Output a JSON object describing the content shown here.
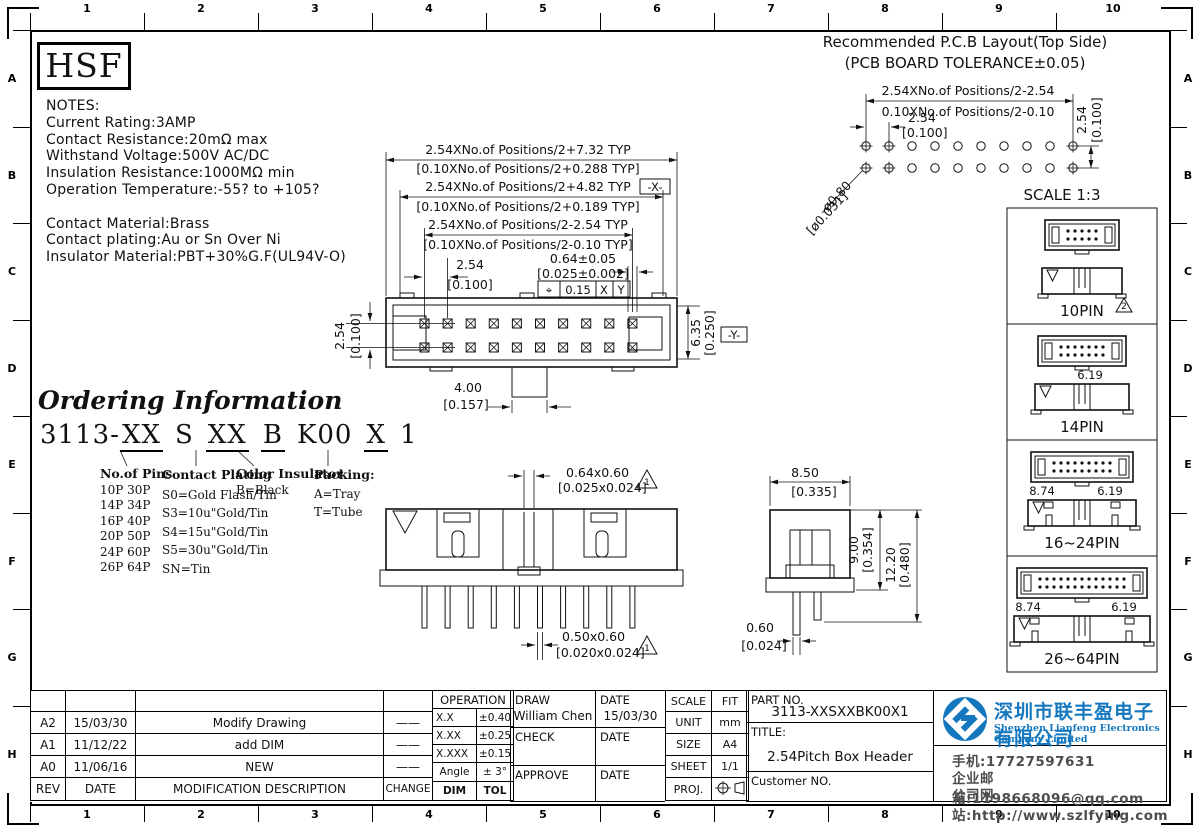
{
  "border": {
    "cols": [
      "1",
      "2",
      "3",
      "4",
      "5",
      "6",
      "7",
      "8",
      "9",
      "10"
    ],
    "rows": [
      "A",
      "B",
      "C",
      "D",
      "E",
      "F",
      "G",
      "H"
    ]
  },
  "logo": {
    "text": "HSF"
  },
  "notes": {
    "lines": [
      "NOTES:",
      "Current  Rating:3AMP",
      "Contact  Resistance:20mΩ    max",
      "Withstand  Voltage:500V  AC/DC",
      "Insulation  Resistance:1000MΩ  min",
      "Operation  Temperature:-55?  to  +105?",
      "",
      "Contact  Material:Brass",
      "Contact  plating:Au  or  Sn  Over  Ni",
      "Insulator  Material:PBT+30%G.F(UL94V-O)"
    ]
  },
  "pcb": {
    "title1": "Recommended  P.C.B  Layout(Top  Side)",
    "title2": "(PCB  BOARD  TOLERANCE±0.05)",
    "dim_row1": "2.54XNo.of Positions/2-2.54",
    "dim_row2": "0.10XNo.of Positions/2-0.10",
    "pitch": "2.54",
    "pitch_in": "[0.100]",
    "row_pitch": "2.54",
    "row_pitch_in": "[0.100]",
    "hole": "ø0.80",
    "hole_in": "[ø0.031]",
    "scale": "SCALE  1:3"
  },
  "top_view": {
    "dim1": "2.54XNo.of Positions/2+7.32 TYP",
    "dim1b": "[0.10XNo.of Positions/2+0.288 TYP]",
    "dim2": "2.54XNo.of Positions/2+4.82 TYP",
    "dim2b": "[0.10XNo.of Positions/2+0.189 TYP]",
    "dim3": "2.54XNo.of Positions/2-2.54 TYP",
    "dim3b": "[0.10XNo.of Positions/2-0.10 TYP]",
    "pin_sq": "0.64±0.05",
    "pin_sq_in": "[0.025±0.002]",
    "gdt": {
      "sym": "⌖",
      "tol": "0.15",
      "d1": "X",
      "d2": "Y"
    },
    "datum_x": "-X-",
    "datum_y": "-Y-",
    "row_pitch": "2.54",
    "row_pitch_in": "[0.100]",
    "pitch": "2.54",
    "pitch_in": "[0.100]",
    "height": "6.35",
    "height_in": "[0.250]",
    "tab": "4.00",
    "tab_in": "[0.157]"
  },
  "ordering": {
    "title": "Ordering Information",
    "code": {
      "prefix": "3113-",
      "p1": "XX",
      "s": "S",
      "p2": "XX",
      "b": "B",
      "k": "K00",
      "x": "X",
      "one": "1"
    },
    "pins_header": "No.of Pins",
    "pins": [
      "10P   30P",
      "14P   34P",
      "16P   40P",
      "20P   50P",
      "24P   60P",
      "26P   64P"
    ],
    "plating_header": "Contact Plating",
    "plating": [
      "S0=Gold Flash/Tin",
      "S3=10u\"Gold/Tin",
      "S4=15u\"Gold/Tin",
      "S5=30u\"Gold/Tin",
      "SN=Tin"
    ],
    "color_header": "Color Insulator",
    "colors": [
      "B=Black"
    ],
    "packing_header": "Packing:",
    "packing": [
      "A=Tray",
      "T=Tube"
    ]
  },
  "front_view": {
    "pin_top": "0.64x0.60",
    "pin_top_in": "[0.025x0.024]",
    "pin_bot": "0.50x0.60",
    "pin_bot_in": "[0.020x0.024]",
    "rev_tri": "1"
  },
  "side_view": {
    "width": "8.50",
    "width_in": "[0.335]",
    "h1": "9.00",
    "h1_in": "[0.354]",
    "h2": "12.20",
    "h2_in": "[0.480]",
    "pin": "0.60",
    "pin_in": "[0.024]"
  },
  "variants": [
    {
      "label": "10PIN",
      "cols": 5,
      "dims": [],
      "rev_tri": "2"
    },
    {
      "label": "14PIN",
      "cols": 7,
      "dims": [
        "6.19"
      ]
    },
    {
      "label": "16~24PIN",
      "cols": 9,
      "dims": [
        "8.74",
        "6.19"
      ]
    },
    {
      "label": "26~64PIN",
      "cols": 13,
      "dims": [
        "8.74",
        "6.19"
      ]
    }
  ],
  "title_block": {
    "rev_headers": {
      "rev": "REV",
      "date": "DATE",
      "desc": "MODIFICATION  DESCRIPTION",
      "change": "CHANGE"
    },
    "revisions": [
      {
        "rev": "A2",
        "date": "15/03/30",
        "desc": "Modify  Drawing",
        "change": "——"
      },
      {
        "rev": "A1",
        "date": "11/12/22",
        "desc": "add  DIM",
        "change": "——"
      },
      {
        "rev": "A0",
        "date": "11/06/16",
        "desc": "NEW",
        "change": "——"
      }
    ],
    "change_word": "CHANGE",
    "operation": {
      "header": "OPERATION",
      "rows": [
        [
          "X.X",
          "±0.40"
        ],
        [
          "X.XX",
          "±0.25"
        ],
        [
          "X.XXX",
          "±0.15"
        ],
        [
          "Angle",
          "± 3°"
        ],
        [
          "DIM",
          "TOL"
        ]
      ]
    },
    "sign": {
      "draw_label": "DRAW",
      "draw_name": "William  Chen",
      "draw_date_label": "DATE",
      "draw_date": "15/03/30",
      "check_label": "CHECK",
      "check_date_label": "DATE",
      "approve_label": "APPROVE",
      "approve_date_label": "DATE"
    },
    "meta": [
      {
        "label": "SCALE",
        "value": "FIT"
      },
      {
        "label": "UNIT",
        "value": "mm"
      },
      {
        "label": "SIZE",
        "value": "A4"
      },
      {
        "label": "SHEET",
        "value": "1/1"
      },
      {
        "label": "PROJ.",
        "value": ""
      }
    ],
    "part_no_label": "PART  NO.",
    "part_no": "3113-XXSXXBK00X1",
    "title_label": "TITLE:",
    "title": "2.54Pitch  Box  Header",
    "customer_label": "Customer  NO."
  },
  "company": {
    "name_cn": "深圳市联丰盈电子有限公司",
    "name_en": "Shenzhen Lianfeng Electronics Company Limited",
    "phone": "手机:17727597631",
    "email": "企业邮箱:1198668096@qq.com",
    "website": "公司网站:http://www.szlfying.com",
    "brand_color": "#1578be"
  }
}
